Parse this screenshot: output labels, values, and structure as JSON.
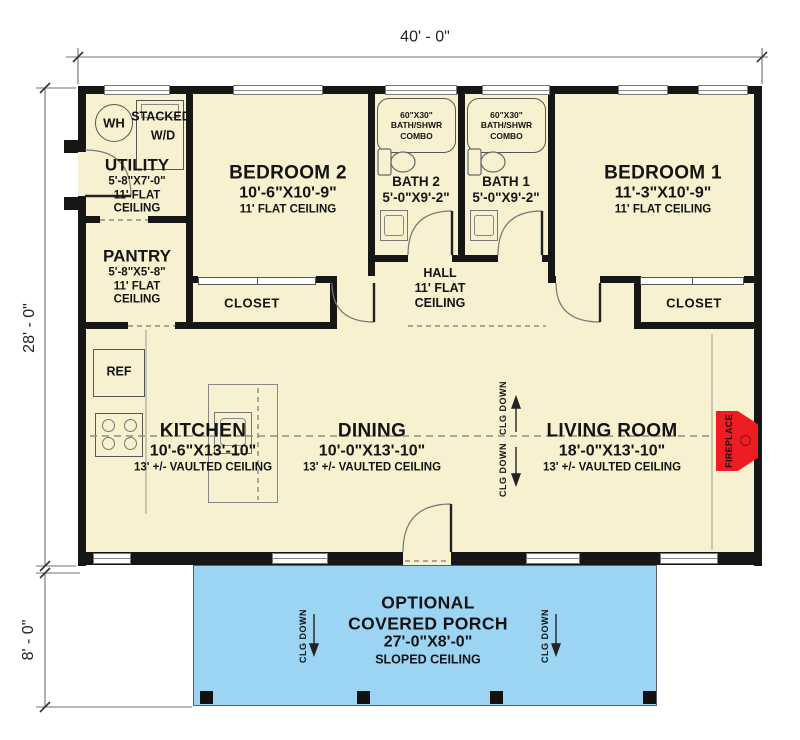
{
  "dimensions": {
    "top": "40' - 0\"",
    "left_main": "28' - 0\"",
    "left_porch": "8' - 0\""
  },
  "rooms": {
    "utility": {
      "name": "UTILITY",
      "size": "5'-8\"X7'-0\"",
      "ceil1": "11' FLAT",
      "ceil2": "CEILING"
    },
    "pantry": {
      "name": "PANTRY",
      "size": "5'-8\"X5'-8\"",
      "ceil1": "11' FLAT",
      "ceil2": "CEILING"
    },
    "bedroom2": {
      "name": "BEDROOM 2",
      "size": "10'-6\"X10'-9\"",
      "ceiling": "11' FLAT CEILING"
    },
    "bedroom1": {
      "name": "BEDROOM 1",
      "size": "11'-3\"X10'-9\"",
      "ceiling": "11' FLAT CEILING"
    },
    "bath2": {
      "name": "BATH 2",
      "size": "5'-0\"X9'-2\""
    },
    "bath1": {
      "name": "BATH 1",
      "size": "5'-0\"X9'-2\""
    },
    "hall": {
      "name": "HALL",
      "ceil1": "11' FLAT",
      "ceil2": "CEILING"
    },
    "kitchen": {
      "name": "KITCHEN",
      "size": "10'-6\"X13'-10\"",
      "ceiling": "13' +/- VAULTED CEILING"
    },
    "dining": {
      "name": "DINING",
      "size": "10'-0\"X13'-10\"",
      "ceiling": "13' +/- VAULTED CEILING"
    },
    "living": {
      "name": "LIVING ROOM",
      "size": "18'-0\"X13'-10\"",
      "ceiling": "13' +/- VAULTED CEILING"
    },
    "porch": {
      "line1": "OPTIONAL",
      "line2": "COVERED PORCH",
      "size": "27'-0\"X8'-0\"",
      "ceiling": "SLOPED CEILING"
    }
  },
  "labels": {
    "closet": "CLOSET",
    "clg_down": "CLG DOWN",
    "tub_l1": "60\"X30\"",
    "tub_l2": "BATH/SHWR",
    "tub_l3": "COMBO",
    "wh": "WH",
    "stacked_l1": "STACKED",
    "stacked_l2": "W/D",
    "ref": "REF",
    "fireplace": "FIREPLACE"
  },
  "colors": {
    "floor": "#F7F1CF",
    "porch": "#9CD4F3",
    "wall": "#161616",
    "fireplace_red": "#EE1C23"
  }
}
